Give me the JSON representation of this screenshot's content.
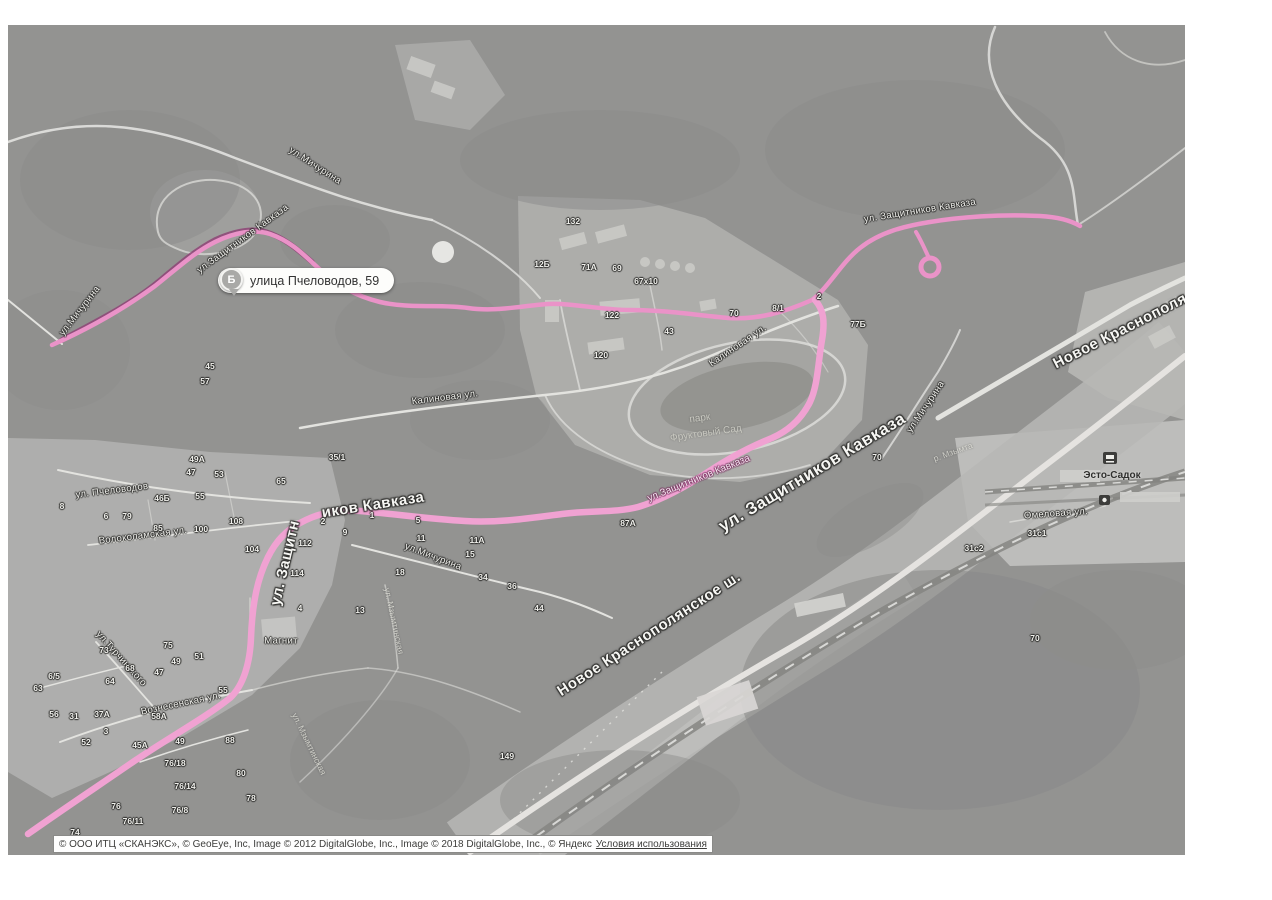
{
  "map": {
    "balloon": {
      "point_letter": "Б",
      "text": "улица Пчеловодов, 59"
    },
    "colors": {
      "route_pink": "#ea93c8",
      "route_pink_bright": "#f0a2d2",
      "route_dark": "#8e4577",
      "forest": "#4f4f4d",
      "road_white": "#eceae6"
    },
    "labels": [
      {
        "t": "ул.Мичурина",
        "x": 315,
        "y": 166,
        "r": 33,
        "cls": "st"
      },
      {
        "t": "ул.Защитников Кавказа",
        "x": 243,
        "y": 239,
        "r": -36,
        "cls": "st"
      },
      {
        "t": "ул.Мичурина",
        "x": 80,
        "y": 311,
        "r": -52,
        "cls": "st"
      },
      {
        "t": "ул. Защитников Кавказа",
        "x": 920,
        "y": 211,
        "r": -9,
        "cls": "st"
      },
      {
        "t": "Калиновая ул.",
        "x": 738,
        "y": 346,
        "r": -34,
        "cls": "st"
      },
      {
        "t": "Калиновая ул.",
        "x": 445,
        "y": 398,
        "r": -7,
        "cls": "st"
      },
      {
        "t": "ул.Мичурина",
        "x": 926,
        "y": 407,
        "r": -56,
        "cls": "st"
      },
      {
        "t": "р. Мзымта",
        "x": 953,
        "y": 452,
        "r": -20,
        "cls": "faint"
      },
      {
        "t": "ул.Мичурина",
        "x": 433,
        "y": 557,
        "r": 21,
        "cls": "st"
      },
      {
        "t": "ул. Пчеловодов",
        "x": 112,
        "y": 491,
        "r": -7,
        "cls": "st"
      },
      {
        "t": "Волоколамская ул.",
        "x": 143,
        "y": 536,
        "r": -7,
        "cls": "st"
      },
      {
        "t": "ул.Турчинского",
        "x": 121,
        "y": 659,
        "r": 48,
        "cls": "st"
      },
      {
        "t": "Вознесенская ул.",
        "x": 181,
        "y": 704,
        "r": -12,
        "cls": "st"
      },
      {
        "t": "Омеловая ул.",
        "x": 1056,
        "y": 514,
        "r": -4,
        "cls": "st"
      },
      {
        "t": "ул. Мзымтинская",
        "x": 394,
        "y": 621,
        "r": 78,
        "cls": "faint"
      },
      {
        "t": "ул. Мзымтинская",
        "x": 309,
        "y": 744,
        "r": 64,
        "cls": "faint"
      },
      {
        "t": "парк",
        "x": 700,
        "y": 419,
        "r": -8,
        "cls": "park"
      },
      {
        "t": "Фруктовый Сад",
        "x": 706,
        "y": 434,
        "r": -8,
        "cls": "park"
      },
      {
        "t": "Новое Краснополя",
        "x": 1120,
        "y": 331,
        "r": -27,
        "cls": "big",
        "fs": 15
      },
      {
        "t": "ул.Защитников Кавказа",
        "x": 699,
        "y": 479,
        "r": -22,
        "cls": "pink"
      },
      {
        "t": "ул. Защитников Кавказа",
        "x": 812,
        "y": 472,
        "r": -31,
        "cls": "big",
        "fs": 17
      },
      {
        "t": "Новое Краснополянское ш.",
        "x": 649,
        "y": 634,
        "r": -33,
        "cls": "big",
        "fs": 15
      },
      {
        "t": "ул. Защитн",
        "x": 285,
        "y": 563,
        "r": -77,
        "cls": "big",
        "fs": 15
      },
      {
        "t": "иков Кавказа",
        "x": 373,
        "y": 505,
        "r": -9,
        "cls": "big",
        "fs": 15
      },
      {
        "t": "Эсто-Садок",
        "x": 1112,
        "y": 476,
        "r": 0,
        "cls": "place"
      },
      {
        "t": "Магнит",
        "x": 281,
        "y": 641,
        "r": 0,
        "cls": "st"
      }
    ],
    "house_numbers": [
      {
        "t": "132",
        "x": 573,
        "y": 221
      },
      {
        "t": "12Б",
        "x": 542,
        "y": 264
      },
      {
        "t": "71А",
        "x": 589,
        "y": 267
      },
      {
        "t": "69",
        "x": 617,
        "y": 268
      },
      {
        "t": "67х10",
        "x": 646,
        "y": 281
      },
      {
        "t": "122",
        "x": 612,
        "y": 315
      },
      {
        "t": "120",
        "x": 601,
        "y": 355
      },
      {
        "t": "43",
        "x": 669,
        "y": 331
      },
      {
        "t": "70",
        "x": 734,
        "y": 313
      },
      {
        "t": "8/1",
        "x": 778,
        "y": 308
      },
      {
        "t": "2",
        "x": 819,
        "y": 296
      },
      {
        "t": "77Б",
        "x": 858,
        "y": 324
      },
      {
        "t": "45",
        "x": 210,
        "y": 366
      },
      {
        "t": "57",
        "x": 205,
        "y": 381
      },
      {
        "t": "35/1",
        "x": 337,
        "y": 457
      },
      {
        "t": "49А",
        "x": 197,
        "y": 459
      },
      {
        "t": "47",
        "x": 191,
        "y": 472
      },
      {
        "t": "53",
        "x": 219,
        "y": 474
      },
      {
        "t": "65",
        "x": 281,
        "y": 481
      },
      {
        "t": "55",
        "x": 200,
        "y": 496
      },
      {
        "t": "46Б",
        "x": 162,
        "y": 498
      },
      {
        "t": "8",
        "x": 62,
        "y": 506
      },
      {
        "t": "6",
        "x": 106,
        "y": 516
      },
      {
        "t": "79",
        "x": 127,
        "y": 516
      },
      {
        "t": "85",
        "x": 158,
        "y": 528
      },
      {
        "t": "100",
        "x": 201,
        "y": 529
      },
      {
        "t": "108",
        "x": 236,
        "y": 521
      },
      {
        "t": "112",
        "x": 305,
        "y": 543
      },
      {
        "t": "104",
        "x": 252,
        "y": 549
      },
      {
        "t": "114",
        "x": 297,
        "y": 573
      },
      {
        "t": "2",
        "x": 323,
        "y": 521
      },
      {
        "t": "9",
        "x": 345,
        "y": 532
      },
      {
        "t": "1",
        "x": 372,
        "y": 515
      },
      {
        "t": "5",
        "x": 418,
        "y": 520
      },
      {
        "t": "11",
        "x": 421,
        "y": 538
      },
      {
        "t": "11А",
        "x": 477,
        "y": 540
      },
      {
        "t": "15",
        "x": 470,
        "y": 554
      },
      {
        "t": "34",
        "x": 483,
        "y": 577
      },
      {
        "t": "18",
        "x": 400,
        "y": 572
      },
      {
        "t": "36",
        "x": 512,
        "y": 586
      },
      {
        "t": "44",
        "x": 539,
        "y": 608
      },
      {
        "t": "4",
        "x": 300,
        "y": 608
      },
      {
        "t": "13",
        "x": 360,
        "y": 610
      },
      {
        "t": "6/5",
        "x": 54,
        "y": 676
      },
      {
        "t": "63",
        "x": 38,
        "y": 688
      },
      {
        "t": "73",
        "x": 104,
        "y": 650
      },
      {
        "t": "75",
        "x": 168,
        "y": 645
      },
      {
        "t": "49",
        "x": 176,
        "y": 661
      },
      {
        "t": "51",
        "x": 199,
        "y": 656
      },
      {
        "t": "47",
        "x": 159,
        "y": 672
      },
      {
        "t": "68",
        "x": 130,
        "y": 668
      },
      {
        "t": "64",
        "x": 110,
        "y": 681
      },
      {
        "t": "55",
        "x": 223,
        "y": 690
      },
      {
        "t": "56",
        "x": 54,
        "y": 714
      },
      {
        "t": "31",
        "x": 74,
        "y": 716
      },
      {
        "t": "37А",
        "x": 102,
        "y": 714
      },
      {
        "t": "58А",
        "x": 159,
        "y": 716
      },
      {
        "t": "3",
        "x": 106,
        "y": 731
      },
      {
        "t": "52",
        "x": 86,
        "y": 742
      },
      {
        "t": "45А",
        "x": 140,
        "y": 745
      },
      {
        "t": "49",
        "x": 180,
        "y": 741
      },
      {
        "t": "88",
        "x": 230,
        "y": 740
      },
      {
        "t": "76/18",
        "x": 175,
        "y": 763
      },
      {
        "t": "80",
        "x": 241,
        "y": 773
      },
      {
        "t": "76/14",
        "x": 185,
        "y": 786
      },
      {
        "t": "78",
        "x": 251,
        "y": 798
      },
      {
        "t": "76/8",
        "x": 180,
        "y": 810
      },
      {
        "t": "76/11",
        "x": 133,
        "y": 821
      },
      {
        "t": "76",
        "x": 116,
        "y": 806
      },
      {
        "t": "74",
        "x": 75,
        "y": 832
      },
      {
        "t": "31с1",
        "x": 1037,
        "y": 533
      },
      {
        "t": "31с2",
        "x": 974,
        "y": 548
      },
      {
        "t": "70",
        "x": 1035,
        "y": 638
      },
      {
        "t": "149",
        "x": 507,
        "y": 756
      },
      {
        "t": "87А",
        "x": 628,
        "y": 523
      },
      {
        "t": "70",
        "x": 877,
        "y": 457
      }
    ]
  },
  "attribution": {
    "text": "© ООО ИТЦ «СКАНЭКС», © GeoEye, Inc, Image © 2012 DigitalGlobe, Inc., Image © 2018 DigitalGlobe, Inc., © Яндекс",
    "link": "Условия использования"
  }
}
